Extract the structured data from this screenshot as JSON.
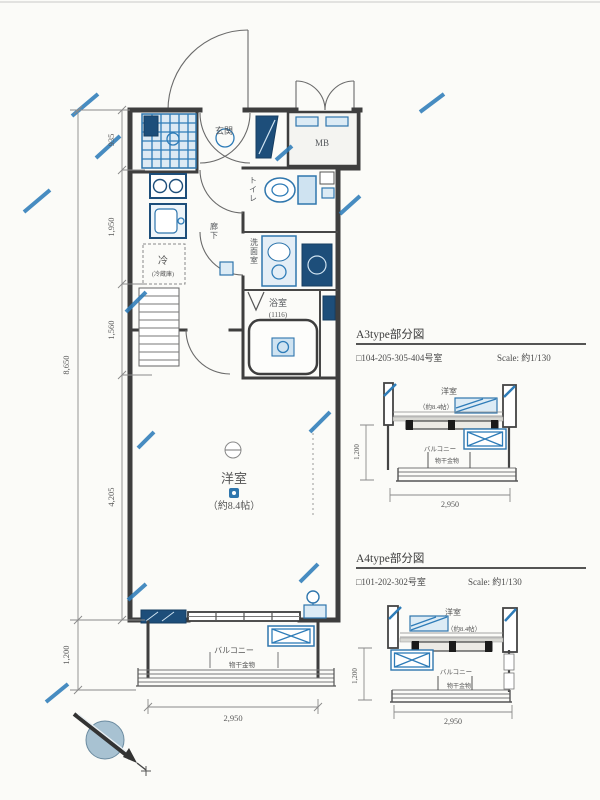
{
  "colors": {
    "wall": "#3e3e3e",
    "accent_blue": "#2e7cb8",
    "light_blue_fill": "#dcebf5",
    "navy_fixture": "#1d4e7a",
    "label_text": "#55585c",
    "background": "#fbfbf8"
  },
  "plan": {
    "rooms": {
      "entrance": "玄関",
      "mb": "MB",
      "toilet": "トイレ",
      "washroom": "洗面室",
      "bathroom": "浴室",
      "bathroom_size": "(1116)",
      "fridge": "冷",
      "fridge_note": "(冷蔵庫)",
      "hallway": "廊下",
      "main_room": "洋室",
      "main_room_size": "（約8.4帖）",
      "balcony": "バルコニー",
      "balcony_note": "物干金物"
    },
    "dimensions": {
      "seg1": "935",
      "seg2": "1,950",
      "seg3": "1,560",
      "seg4": "4,205",
      "total_depth": "8,650",
      "balcony_depth": "1,200",
      "width": "2,950"
    }
  },
  "detail_a3": {
    "title": "A3type部分図",
    "units": "□104-205-305-404号室",
    "scale": "Scale: 約1/130",
    "room": "洋室",
    "room_size": "（約8.4帖）",
    "balcony": "バルコニー",
    "balcony_note": "物干金物",
    "depth": "1,200",
    "width": "2,950"
  },
  "detail_a4": {
    "title": "A4type部分図",
    "units": "□101-202-302号室",
    "scale": "Scale: 約1/130",
    "room": "洋室",
    "room_size": "（約8.4帖）",
    "balcony": "バルコニー",
    "balcony_note": "物干金物",
    "depth": "1,200",
    "width": "2,950"
  }
}
